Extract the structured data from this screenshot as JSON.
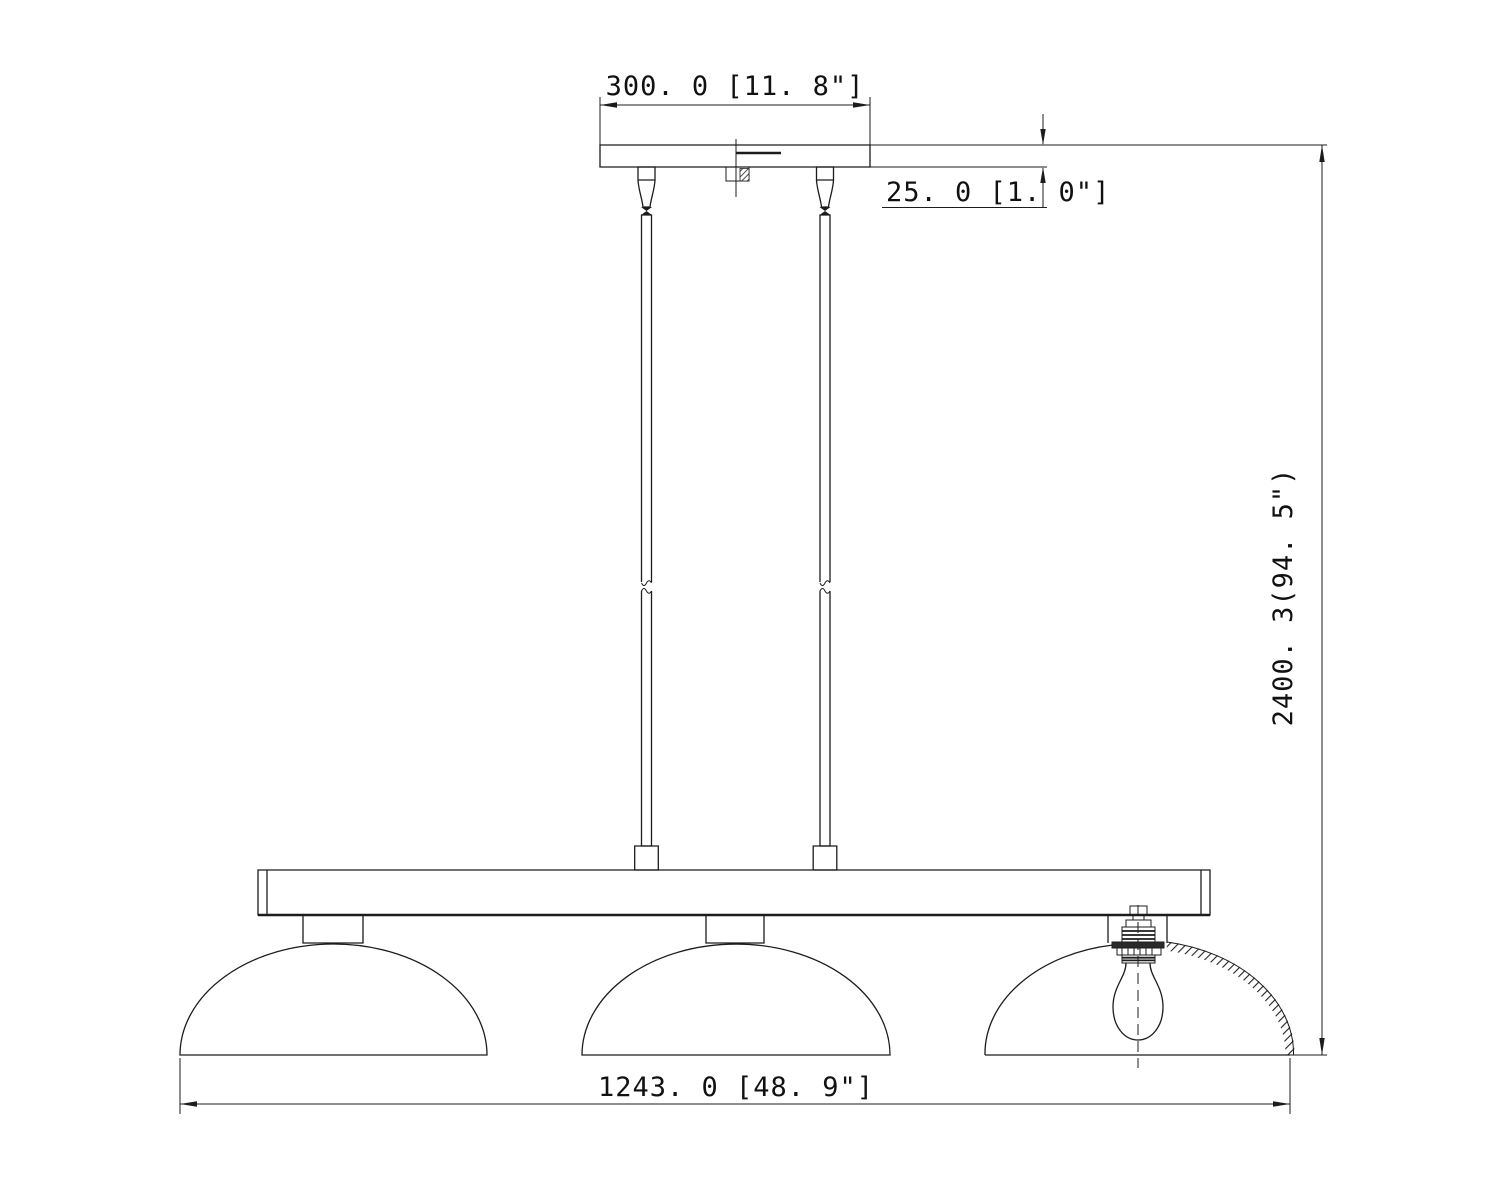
{
  "page": {
    "background_color": "#ffffff",
    "line_color": "#1c1c1c",
    "kind": "technical dimension line drawing",
    "subject": "3-light linear island pendant fixture, side elevation"
  },
  "drawing": {
    "dimensions": {
      "canopy_width": {
        "label": "300. 0  [11. 8\"]",
        "value_mm": 300.0,
        "value_in": 11.8
      },
      "canopy_thickness": {
        "label": "25. 0  [1. 0\"]",
        "value_mm": 25.0,
        "value_in": 1.0
      },
      "overall_height": {
        "label": "2400. 3(94. 5\")",
        "value_mm": 2400.3,
        "value_in": 94.5
      },
      "fixture_width": {
        "label": "1243. 0  [48. 9\"]",
        "value_mm": 1243.0,
        "value_in": 48.9
      }
    }
  }
}
